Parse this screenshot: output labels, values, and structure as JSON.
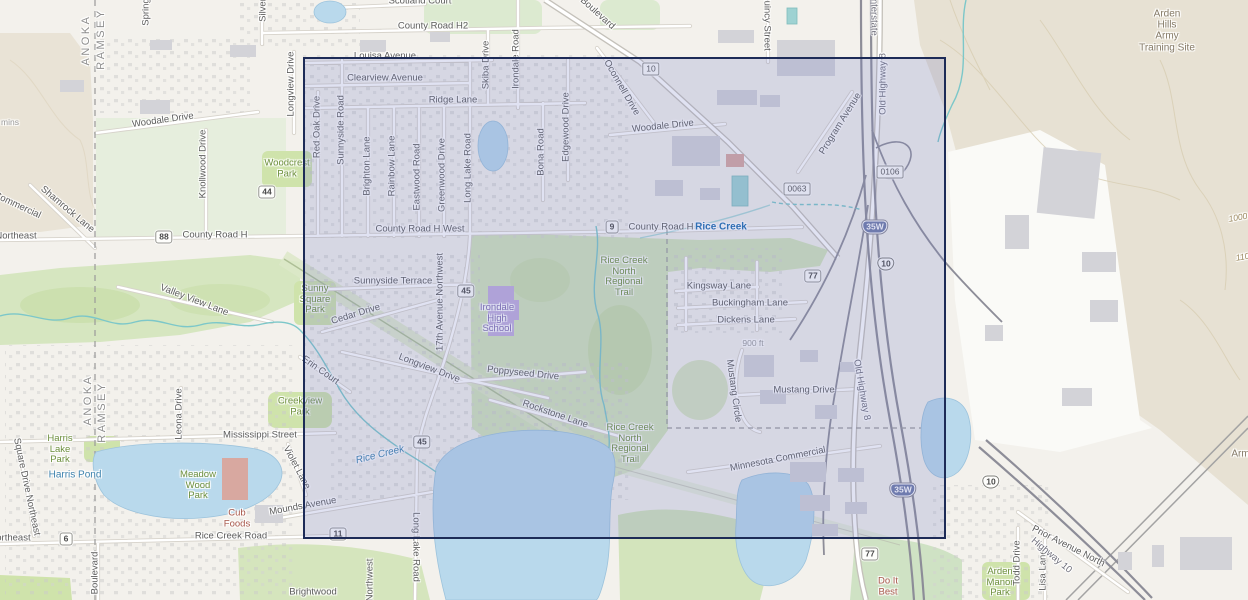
{
  "selection": {
    "x": 303,
    "y": 57,
    "width": 643,
    "height": 482,
    "fill": "rgba(116,122,197,0.22)",
    "border_color": "#1d2b57"
  },
  "colors": {
    "water": "#b9d9ec",
    "park_green": "#cfe3ab",
    "terrain_tan": "#e7e1d3",
    "road_fill": "#ffffff",
    "freeway": "#8d8d98",
    "selection_border": "#1d2b57",
    "water_label": "#3d82ad",
    "park_label": "#6d8f3d",
    "poi_label": "#a8574a"
  },
  "scale_text": "900 ft",
  "labels": [
    {
      "text": "ANOKA",
      "x": 86,
      "y": 40,
      "rot": -90,
      "cls": "county"
    },
    {
      "text": "RAMSEY",
      "x": 101,
      "y": 39,
      "rot": -90,
      "cls": "county"
    },
    {
      "text": "ANOKA",
      "x": 88,
      "y": 400,
      "rot": -90,
      "cls": "county"
    },
    {
      "text": "RAMSEY",
      "x": 102,
      "y": 412,
      "rot": -90,
      "cls": "county"
    },
    {
      "text": "mins",
      "x": 10,
      "y": 123,
      "rot": 0,
      "cls": "faint"
    },
    {
      "text": "Woodale Drive",
      "x": 163,
      "y": 121,
      "rot": -8,
      "cls": "road"
    },
    {
      "text": "County Road H2",
      "x": 433,
      "y": 27,
      "rot": 0,
      "cls": "road"
    },
    {
      "text": "Scotland Court",
      "x": 420,
      "y": 2,
      "rot": 0,
      "cls": "road"
    },
    {
      "text": "Louisa Avenue",
      "x": 385,
      "y": 57,
      "rot": 0,
      "cls": "road"
    },
    {
      "text": "Clearview Avenue",
      "x": 385,
      "y": 79,
      "rot": 0,
      "cls": "road"
    },
    {
      "text": "Ridge Lane",
      "x": 453,
      "y": 101,
      "rot": 0,
      "cls": "road"
    },
    {
      "text": "Boulevard",
      "x": 597,
      "y": 14,
      "rot": 42,
      "cls": "road"
    },
    {
      "text": "Spring",
      "x": 147,
      "y": 12,
      "rot": -90,
      "cls": "road"
    },
    {
      "text": "Silver",
      "x": 264,
      "y": 10,
      "rot": -90,
      "cls": "road"
    },
    {
      "text": "Longview Drive",
      "x": 292,
      "y": 84,
      "rot": -90,
      "cls": "road"
    },
    {
      "text": "Red Oak Drive",
      "x": 318,
      "y": 127,
      "rot": -90,
      "cls": "road"
    },
    {
      "text": "Sunnyside Road",
      "x": 342,
      "y": 130,
      "rot": -90,
      "cls": "road"
    },
    {
      "text": "Brighton Lane",
      "x": 368,
      "y": 166,
      "rot": -90,
      "cls": "road"
    },
    {
      "text": "Rainbow Lane",
      "x": 393,
      "y": 166,
      "rot": -90,
      "cls": "road"
    },
    {
      "text": "Eastwood Road",
      "x": 418,
      "y": 177,
      "rot": -90,
      "cls": "road"
    },
    {
      "text": "Greenwood Drive",
      "x": 443,
      "y": 175,
      "rot": -90,
      "cls": "road"
    },
    {
      "text": "Long Lake Road",
      "x": 469,
      "y": 168,
      "rot": -90,
      "cls": "road"
    },
    {
      "text": "Bona Road",
      "x": 542,
      "y": 152,
      "rot": -90,
      "cls": "road"
    },
    {
      "text": "Edgewood Drive",
      "x": 567,
      "y": 127,
      "rot": -90,
      "cls": "road"
    },
    {
      "text": "Skiba Drive",
      "x": 487,
      "y": 65,
      "rot": -90,
      "cls": "road"
    },
    {
      "text": "Irondale Road",
      "x": 517,
      "y": 59,
      "rot": -90,
      "cls": "road"
    },
    {
      "text": "Woodale Drive",
      "x": 663,
      "y": 127,
      "rot": -6,
      "cls": "road"
    },
    {
      "text": "Oconnell Drive",
      "x": 621,
      "y": 88,
      "rot": 60,
      "cls": "road"
    },
    {
      "text": "Quincy Street",
      "x": 766,
      "y": 22,
      "rot": 90,
      "cls": "road"
    },
    {
      "text": "Interstate",
      "x": 873,
      "y": 16,
      "rot": 90,
      "cls": "fwy"
    },
    {
      "text": "Old Highway 8",
      "x": 884,
      "y": 84,
      "rot": -90,
      "cls": "fwy"
    },
    {
      "text": "Program Avenue",
      "x": 841,
      "y": 124,
      "rot": -58,
      "cls": "road"
    },
    {
      "text": "Knollwood Drive",
      "x": 204,
      "y": 164,
      "rot": -90,
      "cls": "road"
    },
    {
      "text": "Commercial",
      "x": 17,
      "y": 206,
      "rot": 25,
      "cls": "road"
    },
    {
      "text": "Shamrock Lane",
      "x": 67,
      "y": 210,
      "rot": 40,
      "cls": "road"
    },
    {
      "text": "Northeast",
      "x": 16,
      "y": 237,
      "rot": 0,
      "cls": "road"
    },
    {
      "text": "County Road H",
      "x": 215,
      "y": 236,
      "rot": 0,
      "cls": "road"
    },
    {
      "text": "County Road H West",
      "x": 420,
      "y": 230,
      "rot": 0,
      "cls": "road"
    },
    {
      "text": "County Road H",
      "x": 661,
      "y": 228,
      "rot": 0,
      "cls": "road"
    },
    {
      "text": "Rice Creek",
      "x": 721,
      "y": 227,
      "rot": 0,
      "cls": "water-bold"
    },
    {
      "text": "Valley View Lane",
      "x": 194,
      "y": 301,
      "rot": 21,
      "cls": "road"
    },
    {
      "text": "Sunnyside Terrace",
      "x": 393,
      "y": 282,
      "rot": 0,
      "cls": "road"
    },
    {
      "text": "Cedar Drive",
      "x": 356,
      "y": 315,
      "rot": -17,
      "cls": "road"
    },
    {
      "text": "17th Avenue Northwest",
      "x": 441,
      "y": 302,
      "rot": -90,
      "cls": "road"
    },
    {
      "text": "Sunny\nSquare\nPark",
      "x": 315,
      "y": 300,
      "rot": 0,
      "cls": "park"
    },
    {
      "text": "Woodcrest\nPark",
      "x": 287,
      "y": 169,
      "rot": 0,
      "cls": "park"
    },
    {
      "text": "Irondale\nHigh\nSchool",
      "x": 497,
      "y": 319,
      "rot": 0,
      "cls": "school"
    },
    {
      "text": "Rice Creek\nNorth\nRegional\nTrail",
      "x": 624,
      "y": 277,
      "rot": 0,
      "cls": "park"
    },
    {
      "text": "Kingsway Lane",
      "x": 719,
      "y": 287,
      "rot": 0,
      "cls": "road"
    },
    {
      "text": "Buckingham Lane",
      "x": 750,
      "y": 304,
      "rot": 0,
      "cls": "road"
    },
    {
      "text": "Dickens Lane",
      "x": 746,
      "y": 321,
      "rot": 0,
      "cls": "road"
    },
    {
      "text": "900 ft",
      "x": 753,
      "y": 344,
      "rot": 0,
      "cls": "faint"
    },
    {
      "text": "Mustang Circle",
      "x": 733,
      "y": 391,
      "rot": 82,
      "cls": "road"
    },
    {
      "text": "Mustang Drive",
      "x": 804,
      "y": 391,
      "rot": 0,
      "cls": "road"
    },
    {
      "text": "Old Highway 8",
      "x": 861,
      "y": 390,
      "rot": 80,
      "cls": "fwy"
    },
    {
      "text": "Longview Drive",
      "x": 429,
      "y": 369,
      "rot": 21,
      "cls": "road"
    },
    {
      "text": "Poppyseed Drive",
      "x": 523,
      "y": 374,
      "rot": 6,
      "cls": "road"
    },
    {
      "text": "Erin Court",
      "x": 320,
      "y": 371,
      "rot": 35,
      "cls": "road"
    },
    {
      "text": "Rockstone Lane",
      "x": 555,
      "y": 415,
      "rot": 19,
      "cls": "road"
    },
    {
      "text": "Creekview\nPark",
      "x": 300,
      "y": 407,
      "rot": 0,
      "cls": "park"
    },
    {
      "text": "Rice Creek",
      "x": 380,
      "y": 455,
      "rot": -14,
      "cls": "water-italic"
    },
    {
      "text": "Rice Creek\nNorth\nRegional\nTrail",
      "x": 630,
      "y": 444,
      "rot": 0,
      "cls": "park"
    },
    {
      "text": "Minnesota Commercial",
      "x": 778,
      "y": 460,
      "rot": -11,
      "cls": "road"
    },
    {
      "text": "Mississippi Street",
      "x": 260,
      "y": 436,
      "rot": 0,
      "cls": "road"
    },
    {
      "text": "Leona Drive",
      "x": 180,
      "y": 414,
      "rot": -90,
      "cls": "road"
    },
    {
      "text": "Square Drive Northeast",
      "x": 26,
      "y": 487,
      "rot": 78,
      "cls": "road"
    },
    {
      "text": "Violet Lane",
      "x": 296,
      "y": 468,
      "rot": 62,
      "cls": "road"
    },
    {
      "text": "Harris\nLake\nPark",
      "x": 60,
      "y": 450,
      "rot": 0,
      "cls": "park"
    },
    {
      "text": "Harris Pond",
      "x": 75,
      "y": 475,
      "rot": 0,
      "cls": "water"
    },
    {
      "text": "Meadow\nWood\nPark",
      "x": 198,
      "y": 486,
      "rot": 0,
      "cls": "park"
    },
    {
      "text": "Cub\nFoods",
      "x": 237,
      "y": 519,
      "rot": 0,
      "cls": "poi"
    },
    {
      "text": "Mounds Avenue",
      "x": 303,
      "y": 507,
      "rot": -10,
      "cls": "road"
    },
    {
      "text": "Rice Creek Road",
      "x": 231,
      "y": 537,
      "rot": 0,
      "cls": "road"
    },
    {
      "text": "Northeast",
      "x": 10,
      "y": 539,
      "rot": 0,
      "cls": "road"
    },
    {
      "text": "Boulevard",
      "x": 96,
      "y": 573,
      "rot": -90,
      "cls": "road"
    },
    {
      "text": "Brightwood",
      "x": 313,
      "y": 593,
      "rot": 0,
      "cls": "road"
    },
    {
      "text": "Long Lake Road",
      "x": 415,
      "y": 547,
      "rot": 90,
      "cls": "road"
    },
    {
      "text": "Northwest",
      "x": 371,
      "y": 580,
      "rot": -90,
      "cls": "road"
    },
    {
      "text": "Do It\nBest",
      "x": 888,
      "y": 587,
      "rot": 0,
      "cls": "poi"
    },
    {
      "text": "Arden\nManor\nPark",
      "x": 1000,
      "y": 583,
      "rot": 0,
      "cls": "park"
    },
    {
      "text": "Todd Drive",
      "x": 1018,
      "y": 563,
      "rot": -90,
      "cls": "road"
    },
    {
      "text": "Lisa Lane",
      "x": 1044,
      "y": 570,
      "rot": -90,
      "cls": "road"
    },
    {
      "text": "Prior Avenue North",
      "x": 1068,
      "y": 547,
      "rot": 27,
      "cls": "road"
    },
    {
      "text": "Highway 10",
      "x": 1051,
      "y": 556,
      "rot": 40,
      "cls": "fwy"
    },
    {
      "text": "Arden\nHills\nArmy\nTraining Site",
      "x": 1167,
      "y": 31,
      "rot": 0,
      "cls": "terrain"
    },
    {
      "text": "Army",
      "x": 1243,
      "y": 454,
      "rot": 0,
      "cls": "terrain"
    },
    {
      "text": "1000",
      "x": 1238,
      "y": 218,
      "rot": -10,
      "cls": "contour"
    },
    {
      "text": "1100",
      "x": 1245,
      "y": 257,
      "rot": -10,
      "cls": "contour"
    }
  ],
  "shields": [
    {
      "text": "10",
      "x": 651,
      "y": 69,
      "type": "box"
    },
    {
      "text": "0063",
      "x": 797,
      "y": 189,
      "type": "box"
    },
    {
      "text": "0106",
      "x": 890,
      "y": 172,
      "type": "box"
    },
    {
      "text": "35W",
      "x": 875,
      "y": 227,
      "type": "interstate"
    },
    {
      "text": "35W",
      "x": 903,
      "y": 490,
      "type": "interstate"
    },
    {
      "text": "9",
      "x": 612,
      "y": 227,
      "type": "county"
    },
    {
      "text": "88",
      "x": 164,
      "y": 237,
      "type": "county"
    },
    {
      "text": "44",
      "x": 267,
      "y": 192,
      "type": "county"
    },
    {
      "text": "45",
      "x": 466,
      "y": 291,
      "type": "county"
    },
    {
      "text": "45",
      "x": 422,
      "y": 442,
      "type": "county"
    },
    {
      "text": "77",
      "x": 813,
      "y": 276,
      "type": "county"
    },
    {
      "text": "77",
      "x": 870,
      "y": 554,
      "type": "county"
    },
    {
      "text": "11",
      "x": 338,
      "y": 534,
      "type": "county"
    },
    {
      "text": "6",
      "x": 66,
      "y": 539,
      "type": "county"
    },
    {
      "text": "10",
      "x": 886,
      "y": 264,
      "type": "us"
    },
    {
      "text": "10",
      "x": 991,
      "y": 482,
      "type": "us"
    }
  ]
}
